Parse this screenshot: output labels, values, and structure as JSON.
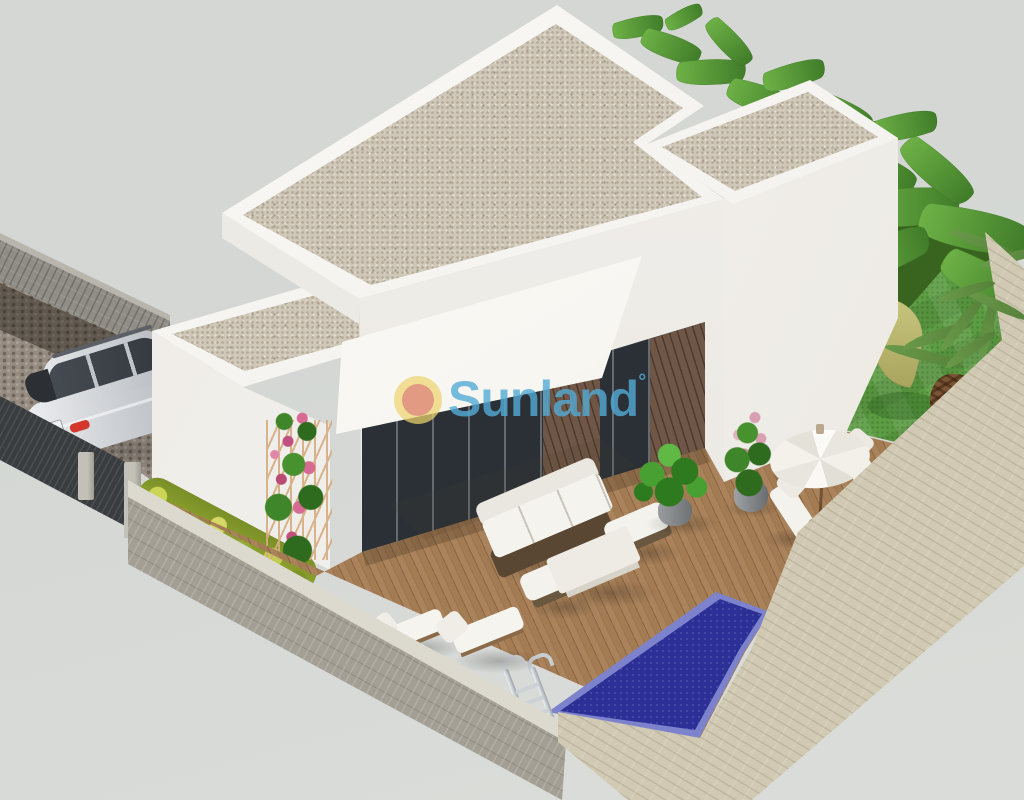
{
  "watermark": {
    "brand": "Sunland",
    "registered_mark": "°"
  },
  "colors": {
    "bg": "#d4d7d4",
    "bg_lower": "#dadcd9",
    "parapet": "#f4f2ee",
    "gravel": "#cfc7b8",
    "wall_white": "#f1efeb",
    "wall_white_bright": "#f8f6f2",
    "awning": "#f7f6f1",
    "glass": "#2b3036",
    "brick": "#6f5646",
    "deck": "#a07a52",
    "deck_dark": "#8a6542",
    "pool_ring": "#7d82cc",
    "pool": "#2b2f96",
    "grass": "#5c9c43",
    "garden_bed": "#38641f",
    "hedge": "#8ea32e",
    "fence": "#3a3d40",
    "post": "#b5b2a9",
    "brickwall": "#8f8d86",
    "cobble": "#968c82",
    "stone_grey_cap": "#dcd9cf",
    "stone_grey": "#a39f95",
    "stone_beige": "#ddd6c0",
    "car_silver": "#ced1d5",
    "car_glass": "#33383e",
    "taillight": "#c23227",
    "wood_trellis": "#d6ac80",
    "rose_pink": "#d66a93",
    "leaf_green": "#6fb347",
    "leaf_dark": "#3f7a28",
    "palm_green": "#55803a",
    "trunk_brown": "#7b5433",
    "umbrella": "#f2f0e9",
    "chrome": "#ccd1d6",
    "logo_yellow": "#ecd46e",
    "logo_salmon": "#e09180",
    "brand_blue": "#54acd6"
  }
}
